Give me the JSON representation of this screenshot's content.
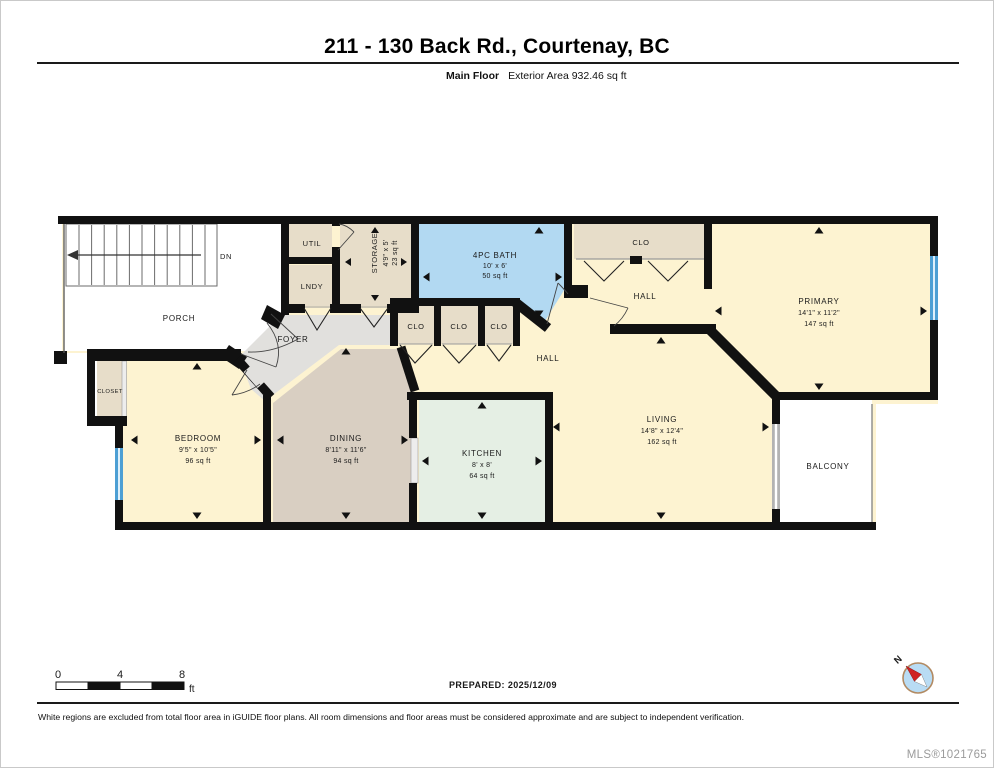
{
  "header": {
    "title": "211 - 130 Back Rd., Courtenay, BC",
    "floor_label": "Main Floor",
    "area_label": "Exterior Area 932.46 sq ft"
  },
  "rooms": {
    "porch": {
      "label": "PORCH"
    },
    "stairs": {
      "label": "DN"
    },
    "foyer": {
      "label": "FOYER"
    },
    "util": {
      "label": "UTIL"
    },
    "lndy": {
      "label": "LNDY"
    },
    "storage": {
      "label": "STORAGE",
      "dims": "4'9\" x 5'",
      "area": "23 sq ft"
    },
    "bath": {
      "label": "4PC BATH",
      "dims": "10' x 6'",
      "area": "50 sq ft"
    },
    "hall_closet": {
      "label": "CLO"
    },
    "hall_upper": {
      "label": "HALL"
    },
    "clo1": {
      "label": "CLO"
    },
    "clo2": {
      "label": "CLO"
    },
    "clo3": {
      "label": "CLO"
    },
    "hall_lower": {
      "label": "HALL"
    },
    "primary": {
      "label": "PRIMARY",
      "dims": "14'1\" x 11'2\"",
      "area": "147 sq ft"
    },
    "closet": {
      "label": "CLOSET"
    },
    "bedroom": {
      "label": "BEDROOM",
      "dims": "9'5\" x 10'5\"",
      "area": "96 sq ft"
    },
    "dining": {
      "label": "DINING",
      "dims": "8'11\" x 11'6\"",
      "area": "94 sq ft"
    },
    "kitchen": {
      "label": "KITCHEN",
      "dims": "8' x 8'",
      "area": "64 sq ft"
    },
    "living": {
      "label": "LIVING",
      "dims": "14'8\" x 12'4\"",
      "area": "162 sq ft"
    },
    "balcony": {
      "label": "BALCONY"
    }
  },
  "scale_bar": {
    "t0": "0",
    "t4": "4",
    "t8": "8",
    "unit": "ft"
  },
  "compass": {
    "north": "N"
  },
  "footer": {
    "prepared": "PREPARED: 2025/12/09",
    "disclaimer": "White regions are excluded from total floor area in iGUIDE floor plans. All room dimensions and floor areas must be considered approximate and are subject to independent verification.",
    "mls": "MLS®1021765"
  },
  "colors": {
    "wall": "#111111",
    "room_cream": "#fdf3d1",
    "room_tan": "#e7ddc9",
    "dining_tan": "#d9cfc2",
    "kitchen_green": "#e5efe4",
    "bath_blue": "#b2d9f2",
    "foyer_gray": "#e1e0dd",
    "window_blue": "#4d9fd4"
  }
}
